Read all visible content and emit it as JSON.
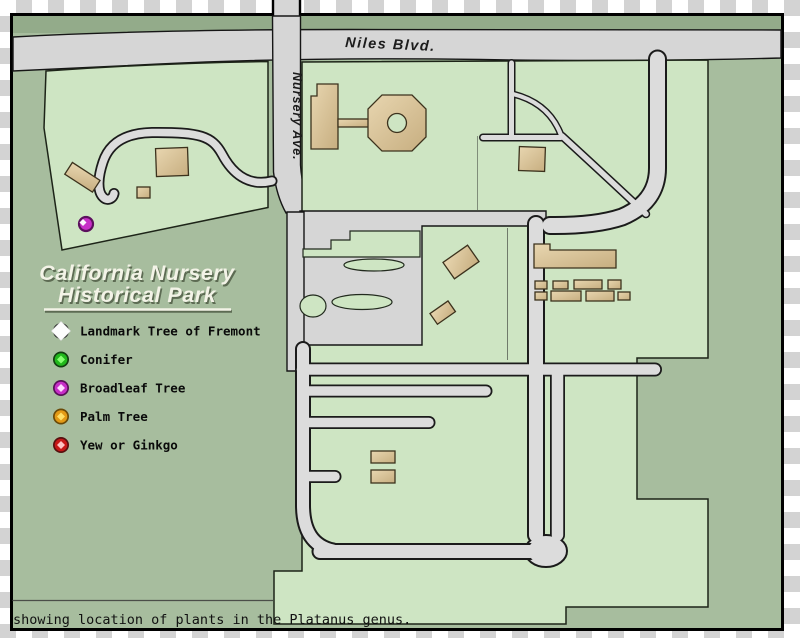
{
  "window": {
    "width": 800,
    "height": 638
  },
  "map": {
    "title": {
      "line1": "California Nursery",
      "line2": "Historical Park"
    },
    "roads": {
      "niles_blvd": "Niles Blvd.",
      "nursery_ave": "Nursery Ave."
    },
    "legend": {
      "items": [
        {
          "label": "Landmark Tree of Fremont",
          "symbol": "white-diamond",
          "color": "#fdfdfd"
        },
        {
          "label": "Conifer",
          "symbol": "green-ball",
          "color": "#22b81c"
        },
        {
          "label": "Broadleaf Tree",
          "symbol": "magenta-ball",
          "color": "#c72ec7"
        },
        {
          "label": "Palm Tree",
          "symbol": "orange-ball",
          "color": "#e39a16"
        },
        {
          "label": "Yew or Ginkgo",
          "symbol": "red-ball",
          "color": "#c71717"
        }
      ]
    },
    "caption": "showing location of plants in the Platanus genus.",
    "markers": [
      {
        "type": "Broadleaf Tree",
        "x": 86,
        "y": 224,
        "color": "#c72ec7"
      }
    ],
    "colors": {
      "park_light_green": "#cee5c3",
      "base_sage_green": "#a7bd9e",
      "upper_strip_green": "#93ab8a",
      "road_gray": "#d6d6d6",
      "building_tan": "#d9c49b",
      "checker_gray": "#d3d3d3",
      "title_cream": "#f3f3e7"
    }
  }
}
